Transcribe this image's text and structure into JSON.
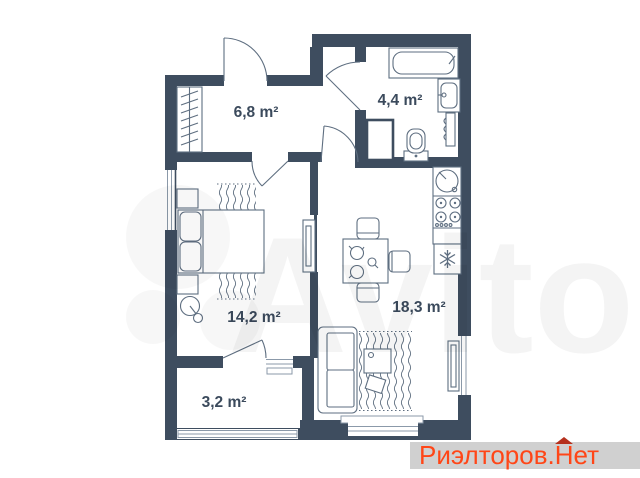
{
  "plan": {
    "wall_color": "#3e4d5f",
    "furniture_line_color": "#5e6e80",
    "label_color": "#3b4a5c",
    "rooms": [
      {
        "name": "hallway",
        "area_label": "6,8 m²"
      },
      {
        "name": "bathroom",
        "area_label": "4,4 m²"
      },
      {
        "name": "bedroom",
        "area_label": "14,2 m²"
      },
      {
        "name": "kitchen-living-room",
        "area_label": "18,3 m²"
      },
      {
        "name": "balcony",
        "area_label": "3,2 m²"
      }
    ],
    "furniture_icons": {
      "hallway": [
        "wardrobe-icon"
      ],
      "bathroom": [
        "bathtub-icon",
        "washbasin-icon",
        "towel-radiator-icon",
        "toilet-icon",
        "duct-shaft-icon"
      ],
      "kitchen": [
        "kitchen-sink-icon",
        "stove-icon",
        "counter-icon",
        "fridge-icon",
        "dining-table-icon",
        "chair-icon"
      ],
      "living": [
        "sofa-icon",
        "rug-icon",
        "coffee-table-icon",
        "pouf-icon",
        "radiator-icon"
      ],
      "bedroom": [
        "double-bed-icon",
        "pillow-icon",
        "bedside-table-icon",
        "rug-icon",
        "floor-lamp-icon",
        "tv-console-icon"
      ]
    }
  },
  "watermarks": {
    "center": {
      "text": "Avito"
    },
    "brand": {
      "part1": "Риэлторов.",
      "part2": "Нет",
      "text_color": "#ff4617",
      "roof_color": "#b5301d",
      "background": "#d0d0d0"
    }
  }
}
